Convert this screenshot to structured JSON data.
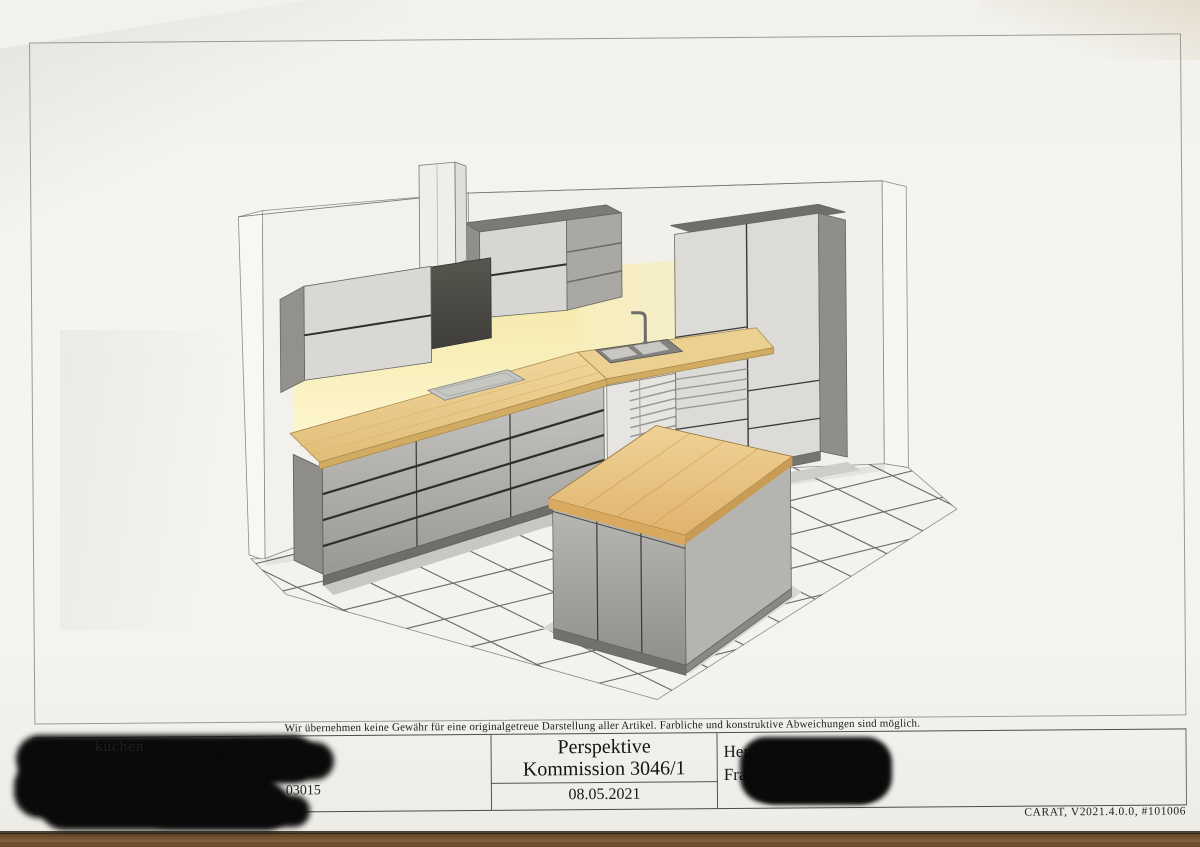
{
  "document": {
    "disclaimer": "Wir übernehmen keine Gewähr für eine originalgetreue Darstellung aller Artikel. Farbliche und konstruktive Abweichungen sind möglich.",
    "title_block": {
      "center": {
        "title": "Perspektive",
        "commission": "Kommission 3046/1",
        "date": "08.05.2021"
      },
      "right": {
        "line1_fragment": "Her",
        "line2_fragment": "Fra",
        "redacted": "true"
      },
      "left": {
        "fragment_top": "küchen",
        "fragment_number": "03015",
        "redacted": "true"
      }
    },
    "footer": "CARAT,  V2021.4.0.0,  #101006"
  },
  "drawing": {
    "type": "kitchen-perspective-rendering",
    "elements": [
      "left-wall",
      "back-wall",
      "tiled-floor",
      "wall-cabinet",
      "extractor-hood-duct",
      "extractor-hood",
      "corner-wall-unit-with-open-shelves",
      "under-cabinet-light-glow",
      "base-cabinets-with-drawers",
      "wood-countertop",
      "cooktop",
      "double-sink",
      "faucet",
      "vented-under-counter-front",
      "tall-cabinet-unit",
      "kitchen-island-with-wood-top"
    ],
    "palette": {
      "paper": "#f4f3ef",
      "desk_background": "#6d4e2f",
      "wood_counter": "#ecd092",
      "island_top_wood": "#e9c47e",
      "cabinet_gray": "#b5b4b1",
      "cabinet_dark_gap": "#2e2e2c",
      "hood_dark": "#4b4a47",
      "glow_yellow": "#f9efba",
      "tile_grout": "#4b4b48",
      "redaction_black": "#0a0a0a"
    }
  }
}
